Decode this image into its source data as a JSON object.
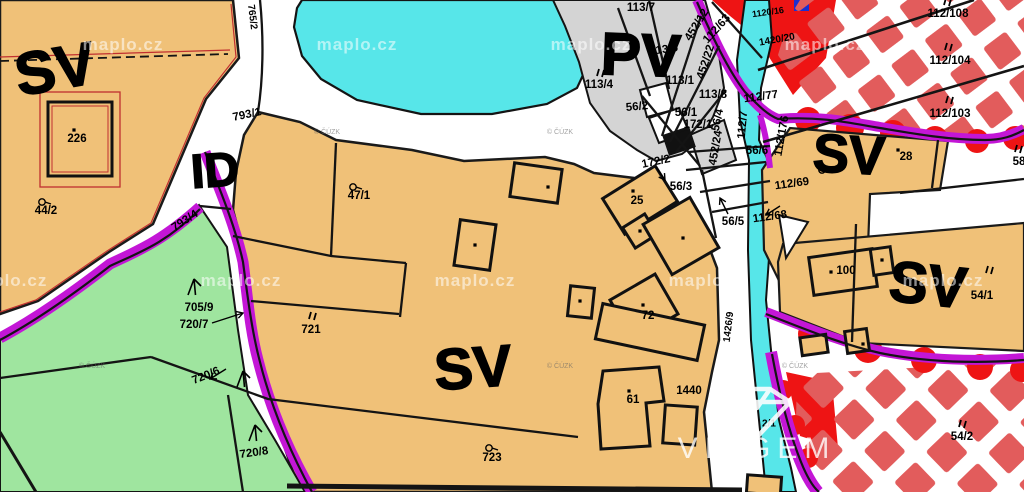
{
  "map": {
    "watermark": "maplo.cz",
    "attribution": "© ČÚZK",
    "logo": {
      "brand": "VIAGEM"
    },
    "colors": {
      "zone_sv_fill": "#f0c178",
      "zone_pv_fill": "#d4d4d4",
      "water_cyan": "#57e6e9",
      "greenery": "#9fe59f",
      "boundary_magenta": "#c316d6",
      "checker_red": "#e25c5c",
      "alert_red": "#ee1414",
      "line_black": "#141414",
      "road_white": "#ffffff"
    },
    "zone_labels": [
      {
        "text": "SV",
        "x": 55,
        "y": 69,
        "size": 60,
        "rot": -10
      },
      {
        "text": "ID",
        "x": 215,
        "y": 171,
        "size": 48,
        "rot": -4
      },
      {
        "text": "PV",
        "x": 641,
        "y": 55,
        "size": 60,
        "rot": 2
      },
      {
        "text": "SV",
        "x": 849,
        "y": 155,
        "size": 54,
        "rot": 3
      },
      {
        "text": "SV",
        "x": 473,
        "y": 368,
        "size": 58,
        "rot": -4
      },
      {
        "text": "SV",
        "x": 928,
        "y": 285,
        "size": 58,
        "rot": 6
      }
    ],
    "parcel_labels": [
      {
        "text": "765/2",
        "x": 252,
        "y": 17,
        "rot": 83,
        "size": 10
      },
      {
        "text": "793/1",
        "x": 247,
        "y": 115,
        "rot": -12
      },
      {
        "text": "226",
        "x": 77,
        "y": 139
      },
      {
        "text": "44/2",
        "x": 46,
        "y": 211
      },
      {
        "text": "793/4",
        "x": 185,
        "y": 221,
        "rot": -33
      },
      {
        "text": "705/9",
        "x": 199,
        "y": 308
      },
      {
        "text": "720/7",
        "x": 194,
        "y": 325
      },
      {
        "text": "721",
        "x": 311,
        "y": 330
      },
      {
        "text": "720/6",
        "x": 206,
        "y": 376,
        "rot": -22
      },
      {
        "text": "720/8",
        "x": 254,
        "y": 453,
        "rot": -8
      },
      {
        "text": "723",
        "x": 492,
        "y": 458
      },
      {
        "text": "47/1",
        "x": 359,
        "y": 196
      },
      {
        "text": "113/7",
        "x": 641,
        "y": 8
      },
      {
        "text": "113/5",
        "x": 664,
        "y": 50,
        "rot": -8
      },
      {
        "text": "113/4",
        "x": 599,
        "y": 85
      },
      {
        "text": "113/1",
        "x": 680,
        "y": 81
      },
      {
        "text": "113/8",
        "x": 713,
        "y": 95
      },
      {
        "text": "56/2",
        "x": 637,
        "y": 107,
        "rot": -5
      },
      {
        "text": "56/1",
        "x": 686,
        "y": 113
      },
      {
        "text": "172/1",
        "x": 698,
        "y": 125
      },
      {
        "text": "172/2",
        "x": 656,
        "y": 162,
        "rot": -12
      },
      {
        "text": "56/3",
        "x": 681,
        "y": 187
      },
      {
        "text": "56/5",
        "x": 733,
        "y": 222
      },
      {
        "text": "56/6",
        "x": 757,
        "y": 151
      },
      {
        "text": "56/4",
        "x": 718,
        "y": 120,
        "rot": -78
      },
      {
        "text": "452/22",
        "x": 706,
        "y": 62,
        "rot": -72
      },
      {
        "text": "452/24",
        "x": 716,
        "y": 148,
        "rot": -80
      },
      {
        "text": "452/12",
        "x": 697,
        "y": 25,
        "rot": -58
      },
      {
        "text": "112/63",
        "x": 717,
        "y": 29,
        "rot": -48
      },
      {
        "text": "112/77",
        "x": 761,
        "y": 97,
        "rot": -8
      },
      {
        "text": "112/7",
        "x": 743,
        "y": 125,
        "rot": -85
      },
      {
        "text": "112/176",
        "x": 782,
        "y": 136,
        "rot": -80
      },
      {
        "text": "112/69",
        "x": 792,
        "y": 184,
        "rot": -8
      },
      {
        "text": "112/68",
        "x": 770,
        "y": 217,
        "rot": -8
      },
      {
        "text": "112/108",
        "x": 948,
        "y": 14
      },
      {
        "text": "112/104",
        "x": 950,
        "y": 61
      },
      {
        "text": "112/103",
        "x": 950,
        "y": 114
      },
      {
        "text": "1120/16",
        "x": 768,
        "y": 12,
        "rot": -8,
        "size": 9
      },
      {
        "text": "1420/20",
        "x": 777,
        "y": 40,
        "rot": -10,
        "size": 10
      },
      {
        "text": "28",
        "x": 906,
        "y": 157
      },
      {
        "text": "58",
        "x": 1019,
        "y": 162
      },
      {
        "text": "100",
        "x": 846,
        "y": 271
      },
      {
        "text": "54/1",
        "x": 982,
        "y": 296
      },
      {
        "text": "54/2",
        "x": 962,
        "y": 437
      },
      {
        "text": "1440",
        "x": 689,
        "y": 391
      },
      {
        "text": "61",
        "x": 633,
        "y": 400
      },
      {
        "text": "72",
        "x": 648,
        "y": 316
      },
      {
        "text": "25",
        "x": 637,
        "y": 201
      },
      {
        "text": "1426/9",
        "x": 729,
        "y": 327,
        "rot": -83,
        "size": 10
      },
      {
        "text": "2/1",
        "x": 769,
        "y": 424,
        "size": 10
      }
    ],
    "building_dots": [
      [
        74,
        130
      ],
      [
        633,
        191
      ],
      [
        548,
        187
      ],
      [
        475,
        245
      ],
      [
        640,
        231
      ],
      [
        683,
        238
      ],
      [
        643,
        305
      ],
      [
        580,
        301
      ],
      [
        629,
        391
      ],
      [
        898,
        150
      ],
      [
        831,
        272
      ],
      [
        882,
        260
      ],
      [
        863,
        344
      ]
    ],
    "double_tick_marks": [
      [
        309,
        319
      ],
      [
        597,
        76
      ],
      [
        944,
        5
      ],
      [
        945,
        50
      ],
      [
        946,
        103
      ],
      [
        986,
        273
      ],
      [
        959,
        427
      ],
      [
        1015,
        152
      ]
    ],
    "garden_symbols": [
      [
        42,
        202
      ],
      [
        353,
        187
      ],
      [
        489,
        448
      ],
      [
        822,
        170
      ]
    ],
    "grass_symbols": [
      [
        194,
        287
      ],
      [
        243,
        379
      ],
      [
        255,
        433
      ]
    ],
    "arrows": [
      {
        "x1": 656,
        "y1": 167,
        "x2": 665,
        "y2": 180
      },
      {
        "x1": 728,
        "y1": 214,
        "x2": 720,
        "y2": 198
      },
      {
        "x1": 212,
        "y1": 323,
        "x2": 243,
        "y2": 313
      },
      {
        "x1": 226,
        "y1": 369,
        "x2": 210,
        "y2": 379
      },
      {
        "x1": 780,
        "y1": 206,
        "x2": 766,
        "y2": 215
      }
    ],
    "watermark_positions": [
      [
        123,
        50
      ],
      [
        357,
        50
      ],
      [
        591,
        50
      ],
      [
        825,
        50
      ],
      [
        7,
        286
      ],
      [
        241,
        286
      ],
      [
        475,
        286
      ],
      [
        709,
        286
      ],
      [
        943,
        286
      ]
    ],
    "attribution_positions": [
      [
        327,
        134
      ],
      [
        560,
        134
      ],
      [
        92,
        368
      ],
      [
        560,
        368
      ],
      [
        795,
        368
      ]
    ]
  }
}
